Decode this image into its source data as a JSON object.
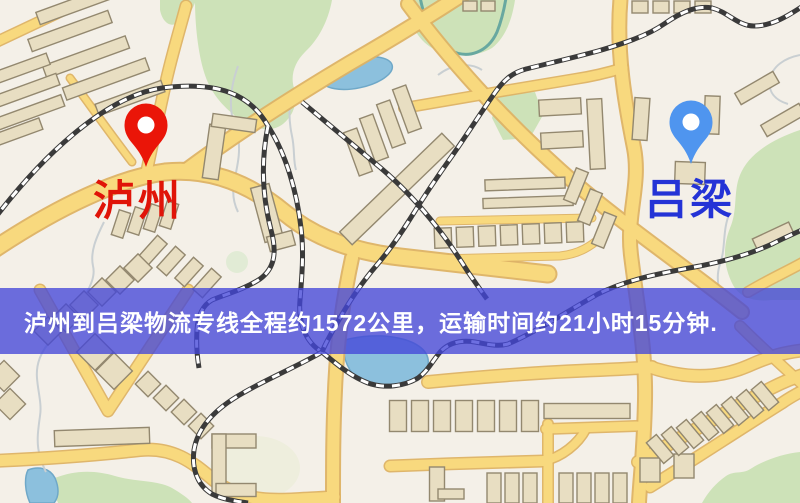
{
  "banner": {
    "text": "泸州到吕梁物流专线全程约1572公里，运输时间约21小时15分钟.",
    "overlay_color": "#4447d8",
    "text_color": "#ffffff"
  },
  "route": {
    "origin": "泸州",
    "destination": "吕梁",
    "distance_text": "约1572公里",
    "duration_text": "约21小时15分钟"
  },
  "markers": [
    {
      "name": "泸州",
      "role": "origin",
      "pin_color": "#ea1508",
      "label_color": "#e01408"
    },
    {
      "name": "吕梁",
      "role": "destination",
      "pin_color": "#4f95ef",
      "label_color": "#2433d6"
    }
  ],
  "map_palette": {
    "background": "#f4f0e8",
    "road": "#f8d97e",
    "road_casing": "#ddb264",
    "building": "#e8dec2",
    "park_green": "#cde2b8",
    "water_blue": "#8cc0dd",
    "railway": "#3a3a3a"
  }
}
